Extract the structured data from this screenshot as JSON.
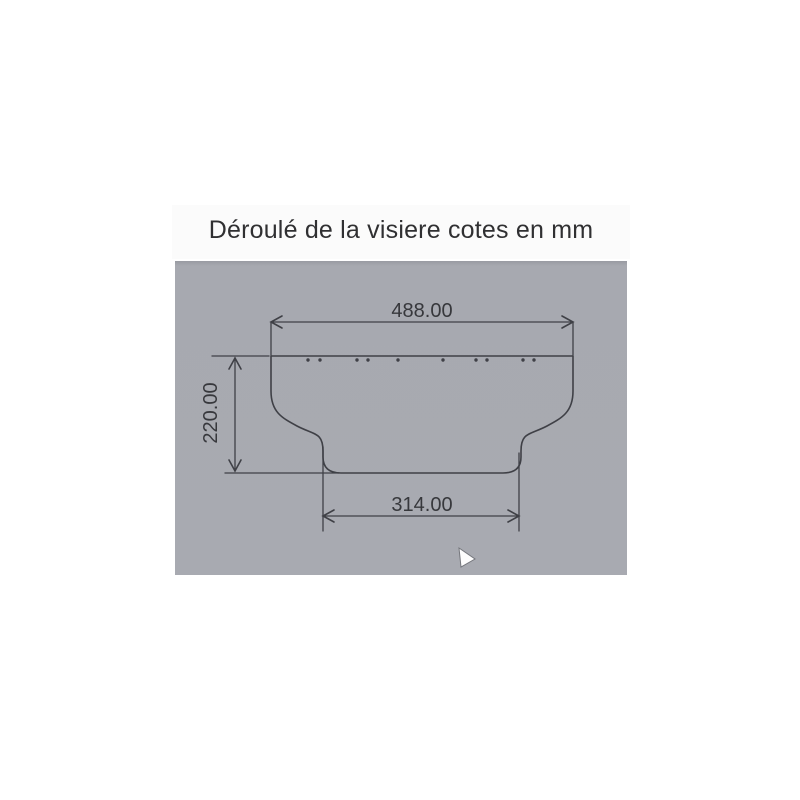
{
  "page": {
    "title": "Déroulé de la visiere cotes en mm"
  },
  "drawing": {
    "dimensions": {
      "top_width_mm": "488.00",
      "side_height_mm": "220.00",
      "bottom_width_mm": "314.00"
    },
    "holes": {
      "count": 10,
      "groups_left_to_right": [
        2,
        2,
        1,
        1,
        2,
        2
      ]
    },
    "colors": {
      "panel_background": "#a8aab1",
      "line": "#3f4046",
      "dimension_text": "#37383c"
    }
  },
  "cursor": {
    "type": "arrow-pointer"
  }
}
